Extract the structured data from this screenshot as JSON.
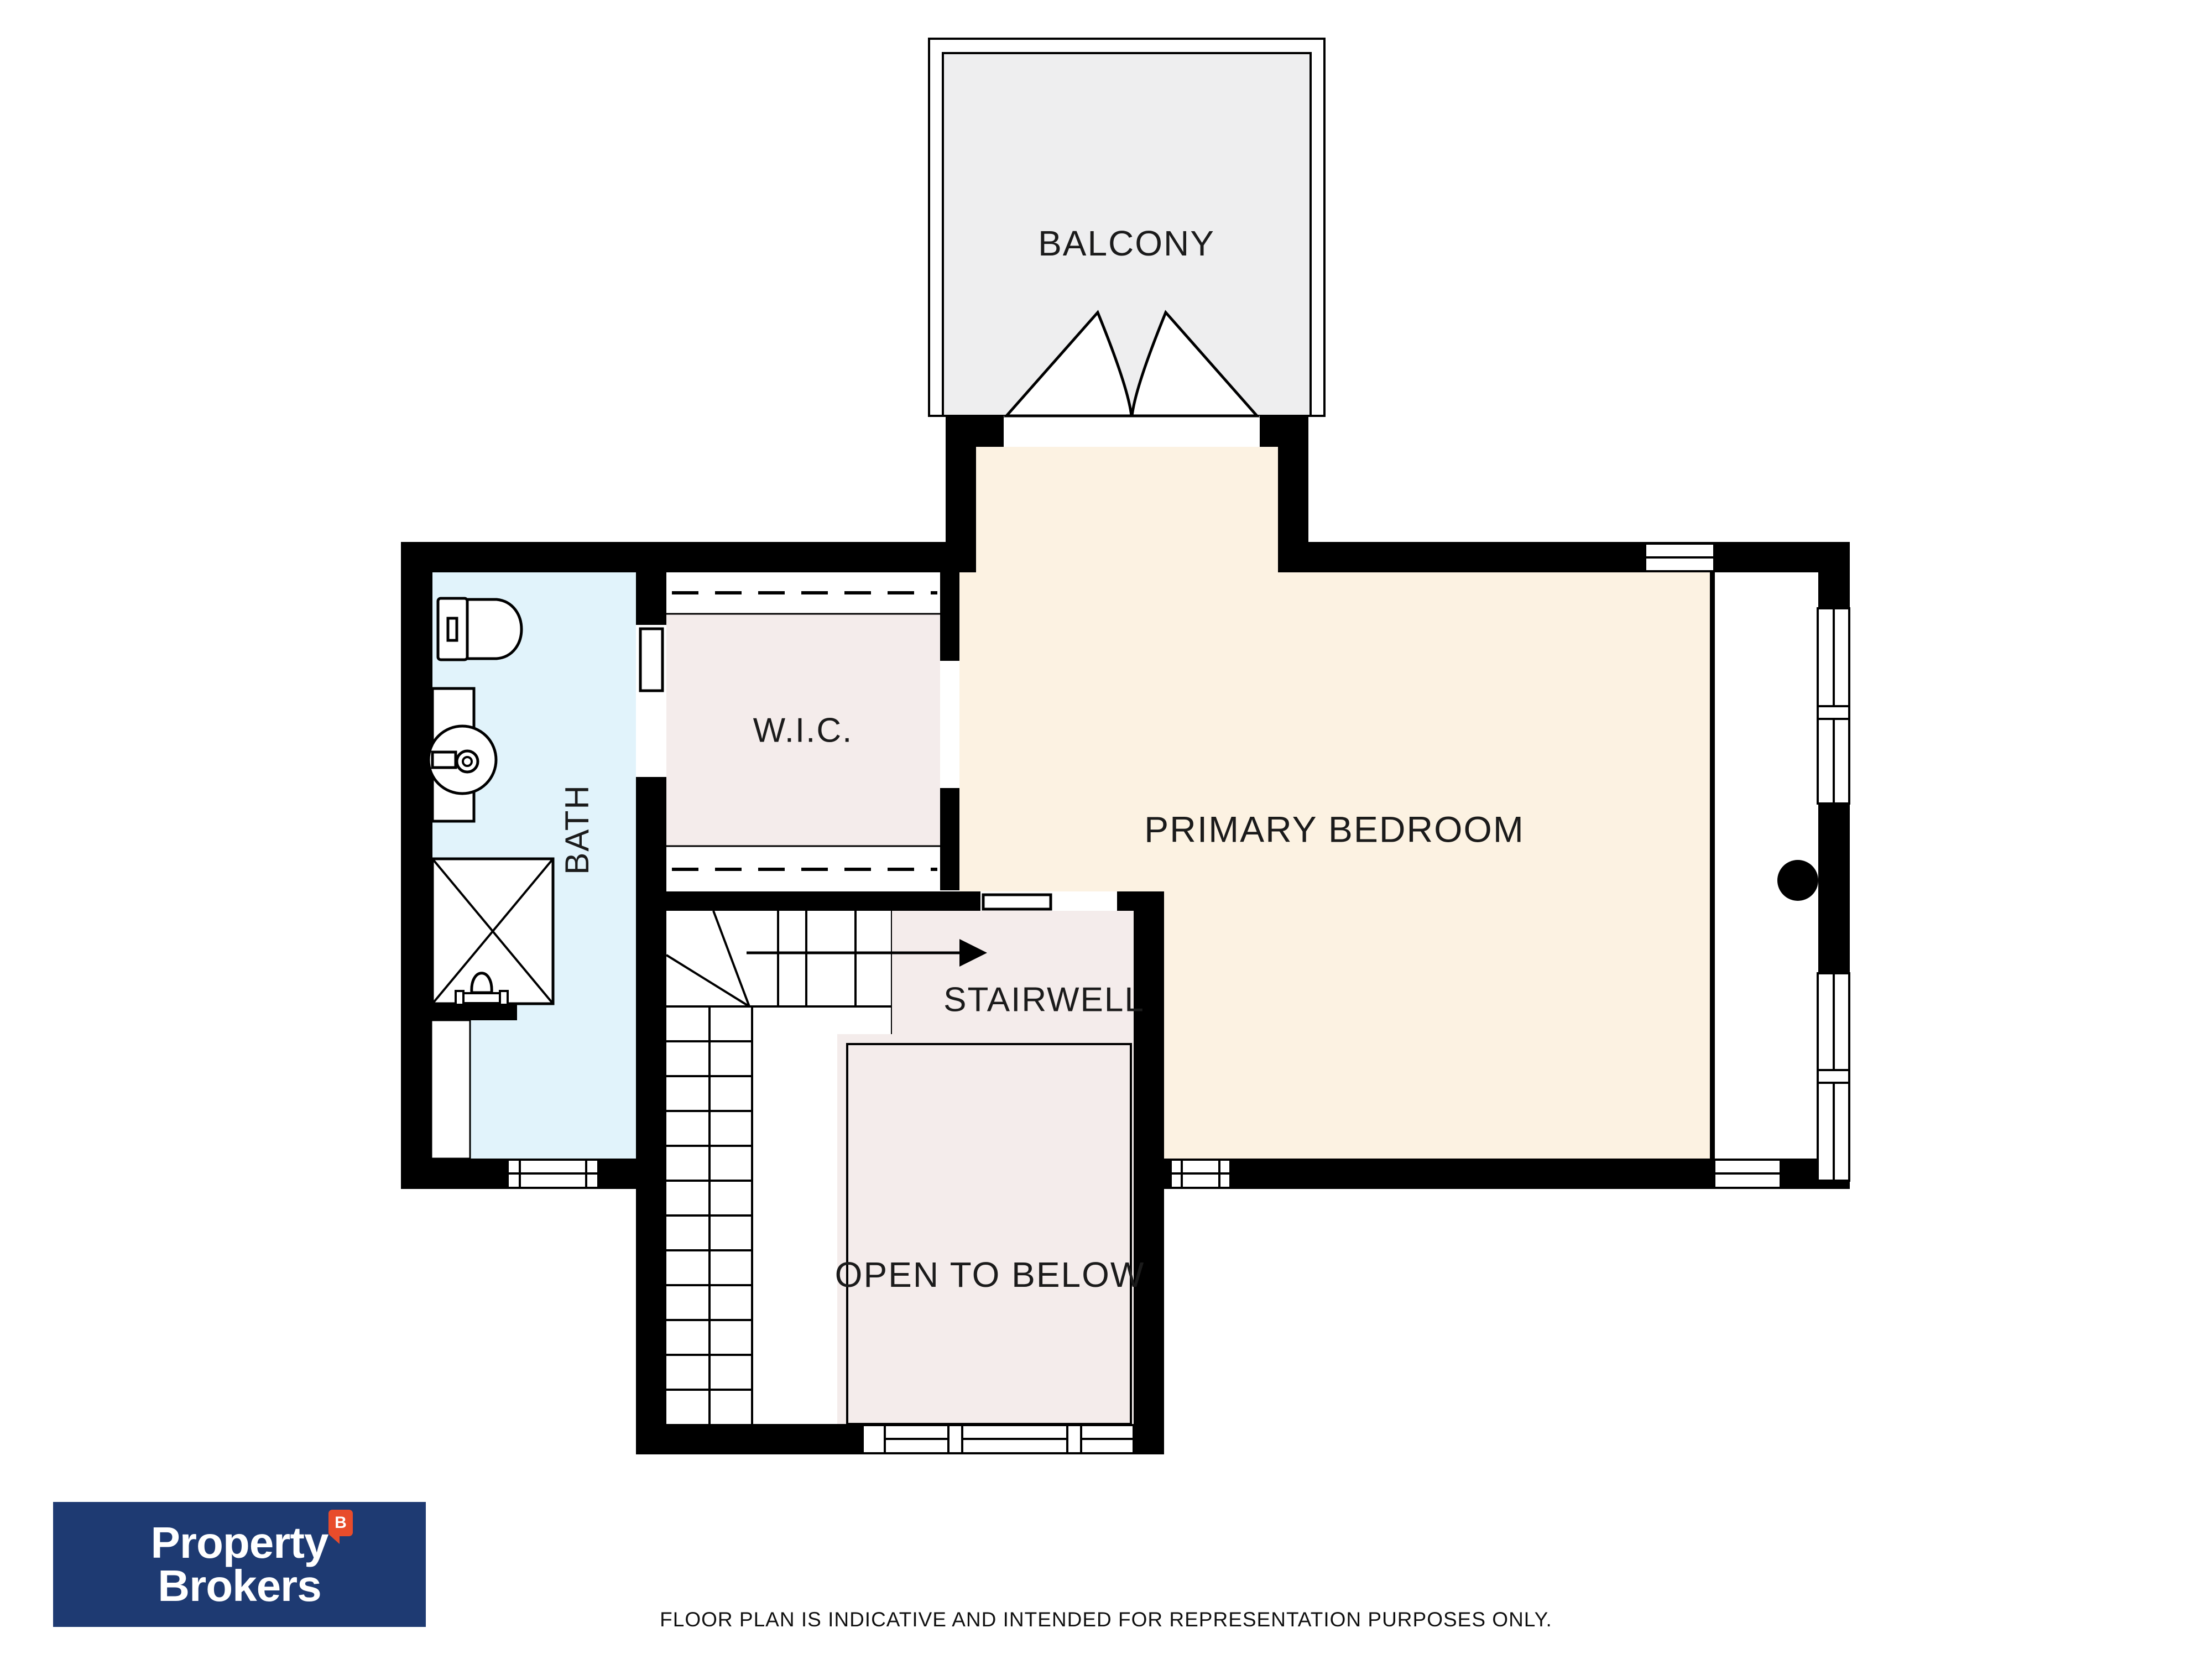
{
  "plan": {
    "labels": {
      "balcony": "BALCONY",
      "primary_bedroom": "PRIMARY BEDROOM",
      "wic": "W.I.C.",
      "bath": "BATH",
      "stairwell": "STAIRWELL",
      "open_to_below": "OPEN TO BELOW"
    },
    "colors": {
      "wall": "#000000",
      "bedroom_fill": "#fcf2e2",
      "bath_fill": "#e1f3fb",
      "closet_and_void_fill": "#f4eceb",
      "balcony_fill": "#eeeeef"
    }
  },
  "branding": {
    "logo_line1": "Property",
    "logo_line2": "Brokers",
    "badge_letter": "B",
    "logo_bg": "#1e3a72",
    "badge_bg": "#e84c2b"
  },
  "footer": {
    "disclaimer": "FLOOR PLAN IS INDICATIVE AND INTENDED FOR REPRESENTATION PURPOSES ONLY."
  }
}
